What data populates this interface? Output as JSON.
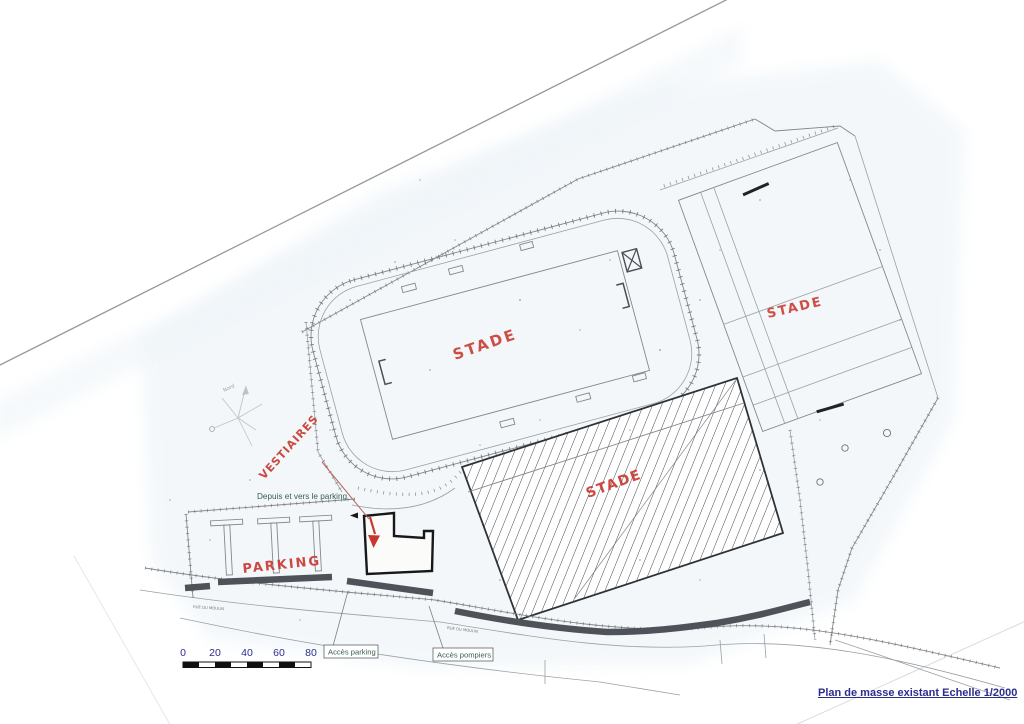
{
  "caption": {
    "text": "Plan de masse  existant Echelle 1/2000"
  },
  "plan": {
    "labels": {
      "stade_track": "STADE",
      "stade_right": "STADE",
      "stade_building": "STADE",
      "vestiaires": "VESTIAIRES",
      "parking": "PARKING",
      "route_note": "Depuis et vers le parking",
      "access_parking": "Accès parking",
      "access_firefighters": "Accès pompiers",
      "north": "Nord",
      "street_main": "RUE DU MOULIN",
      "street_secondary": "RUE DU MOULIN"
    },
    "scale_bar": {
      "ticks": [
        "0",
        "20",
        "40",
        "60",
        "80"
      ]
    },
    "colors": {
      "annotation_red": "#c8372d",
      "caption_navy": "#2b2d8c",
      "label_green": "#355e50",
      "ink_gray": "#5d6166",
      "hedge_gray": "#4d5358"
    }
  }
}
